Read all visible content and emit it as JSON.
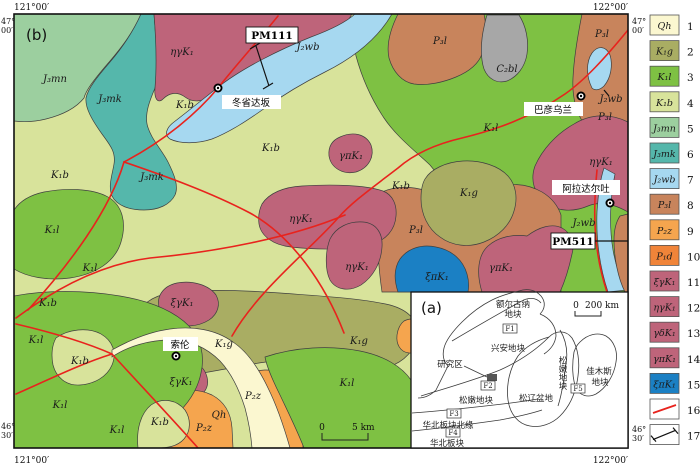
{
  "figure": {
    "panel_b": "(b)",
    "panel_a": "(a)"
  },
  "map": {
    "coords": {
      "top_left": "121°00′",
      "top_right": "122°00′",
      "bottom_left": "121°00′",
      "bottom_right": "122°00′",
      "lat_top_deg": "47°",
      "lat_top_min": "00′",
      "lat_bot_deg": "46°",
      "lat_bot_min": "30′"
    },
    "scale": {
      "zero": "0",
      "end": "5 km"
    },
    "places": [
      {
        "name": "冬省达坂"
      },
      {
        "name": "巴彦乌兰"
      },
      {
        "name": "阿拉达尔吐"
      },
      {
        "name": "索伦"
      }
    ],
    "sections": [
      {
        "name": "PM111"
      },
      {
        "name": "PM511"
      }
    ],
    "unit_labels": [
      {
        "t": "J₃mn",
        "x": 55,
        "y": 82
      },
      {
        "t": "J₃mk",
        "x": 110,
        "y": 102
      },
      {
        "t": "J₃mk",
        "x": 152,
        "y": 180
      },
      {
        "t": "ηγK₁",
        "x": 182,
        "y": 55
      },
      {
        "t": "J₂wb",
        "x": 308,
        "y": 50
      },
      {
        "t": "K₁b",
        "x": 185,
        "y": 108
      },
      {
        "t": "K₁b",
        "x": 271,
        "y": 151
      },
      {
        "t": "K₁b",
        "x": 60,
        "y": 178
      },
      {
        "t": "K₁l",
        "x": 52,
        "y": 233
      },
      {
        "t": "K₁l",
        "x": 90,
        "y": 271
      },
      {
        "t": "K₁b",
        "x": 48,
        "y": 306
      },
      {
        "t": "P₃l",
        "x": 440,
        "y": 44
      },
      {
        "t": "C₂bl",
        "x": 507,
        "y": 72
      },
      {
        "t": "P₃l",
        "x": 602,
        "y": 37
      },
      {
        "t": "J₂wb",
        "x": 611,
        "y": 102
      },
      {
        "t": "K₁l",
        "x": 491,
        "y": 131
      },
      {
        "t": "P₃l",
        "x": 605,
        "y": 120
      },
      {
        "t": "ηγK₁",
        "x": 601,
        "y": 165
      },
      {
        "t": "J₂wb",
        "x": 584,
        "y": 226
      },
      {
        "t": "γπK₁",
        "x": 351,
        "y": 159
      },
      {
        "t": "ηγK₁",
        "x": 301,
        "y": 222
      },
      {
        "t": "ηγK₁",
        "x": 357,
        "y": 270
      },
      {
        "t": "K₁g",
        "x": 469,
        "y": 196
      },
      {
        "t": "K₁b",
        "x": 401,
        "y": 189
      },
      {
        "t": "P₃l",
        "x": 416,
        "y": 233
      },
      {
        "t": "ξπK₁",
        "x": 437,
        "y": 280
      },
      {
        "t": "γπK₁",
        "x": 501,
        "y": 271
      },
      {
        "t": "ξγK₁",
        "x": 182,
        "y": 306
      },
      {
        "t": "ξγK₁",
        "x": 181,
        "y": 385
      },
      {
        "t": "K₁g",
        "x": 224,
        "y": 347
      },
      {
        "t": "K₁g",
        "x": 359,
        "y": 344
      },
      {
        "t": "Qh",
        "x": 219,
        "y": 418
      },
      {
        "t": "P₂z",
        "x": 253,
        "y": 399
      },
      {
        "t": "P₂z",
        "x": 204,
        "y": 431
      },
      {
        "t": "K₁b",
        "x": 80,
        "y": 364
      },
      {
        "t": "K₁b",
        "x": 160,
        "y": 425
      },
      {
        "t": "K₁l",
        "x": 36,
        "y": 343
      },
      {
        "t": "K₁l",
        "x": 60,
        "y": 408
      },
      {
        "t": "K₁l",
        "x": 117,
        "y": 433
      },
      {
        "t": "K₁l",
        "x": 347,
        "y": 386
      }
    ]
  },
  "inset": {
    "scale": {
      "zero": "0",
      "end": "200 km"
    },
    "labels": {
      "erguna_1": "额尔古纳",
      "erguna_2": "地块",
      "xingan": "兴安地块",
      "study_area": "研究区",
      "songnen": "松嫩地块",
      "songliao": "松辽盆地",
      "songnen_vertical": "松嫩地块",
      "jiamusi_1": "佳木斯",
      "jiamusi_2": "地块",
      "ncc_margin": "华北板块北缘",
      "ncc": "华北板块",
      "f1": "F1",
      "f2": "F2",
      "f3": "F3",
      "f4": "F4",
      "f5": "F5"
    }
  },
  "legend": {
    "items": [
      {
        "num": "1",
        "label": "Qh",
        "color": "#FBF7D0",
        "type": "box"
      },
      {
        "num": "2",
        "label": "K₁g",
        "color": "#A9AD63",
        "type": "box"
      },
      {
        "num": "3",
        "label": "K₁l",
        "color": "#7EC143",
        "type": "box"
      },
      {
        "num": "4",
        "label": "K₁b",
        "color": "#D8E39B",
        "type": "box"
      },
      {
        "num": "5",
        "label": "J₃mn",
        "color": "#9CCF9F",
        "type": "box"
      },
      {
        "num": "6",
        "label": "J₃mk",
        "color": "#55B7AB",
        "type": "box"
      },
      {
        "num": "7",
        "label": "J₂wb",
        "color": "#A6D8F0",
        "type": "box"
      },
      {
        "num": "8",
        "label": "P₃l",
        "color": "#C8845C",
        "type": "box"
      },
      {
        "num": "9",
        "label": "P₂z",
        "color": "#F5A54E",
        "type": "box"
      },
      {
        "num": "10",
        "label": "P₁d",
        "color": "#F08439",
        "type": "box"
      },
      {
        "num": "11",
        "label": "ξγK₁",
        "color": "#BE647A",
        "type": "box"
      },
      {
        "num": "12",
        "label": "ηγK₁",
        "color": "#BE647A",
        "type": "box"
      },
      {
        "num": "13",
        "label": "γδK₁",
        "color": "#BE647A",
        "type": "box"
      },
      {
        "num": "14",
        "label": "γπK₁",
        "color": "#BE647A",
        "type": "box"
      },
      {
        "num": "15",
        "label": "ξπK₁",
        "color": "#1B80C4",
        "type": "box"
      },
      {
        "num": "16",
        "label": "",
        "type": "fault",
        "color": "#E8231D"
      },
      {
        "num": "17",
        "label": "",
        "type": "section",
        "color": "#111111"
      }
    ]
  }
}
